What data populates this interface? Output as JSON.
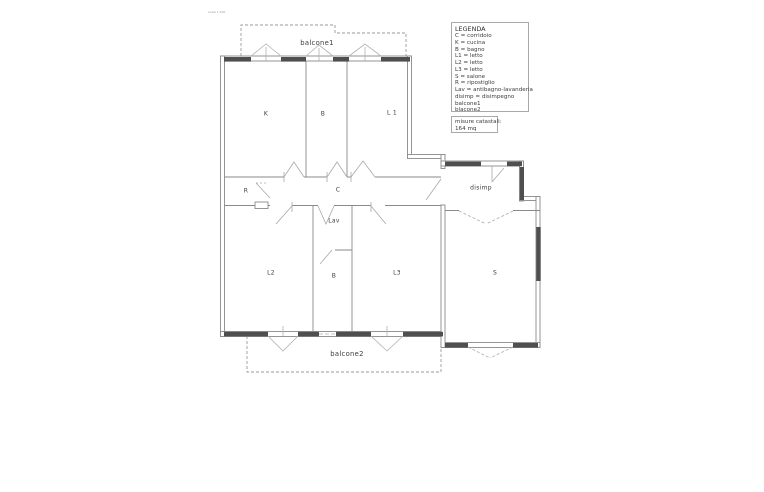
{
  "page": {
    "scale_note": "scala 1:100"
  },
  "legend": {
    "title": "LEGENDA",
    "lines": [
      "C = corridoio",
      "K = cucina",
      "B = bagno",
      "L1 = letto",
      "L2 = letto",
      "L3 = letto",
      "S = salone",
      "R = ripostiglio",
      "Lav = antibagno-lavanderia",
      "disimp = disimpegno",
      "balcone1",
      "blacone2"
    ]
  },
  "measurements": {
    "lines": [
      "misure catastali:",
      "164 mq"
    ]
  },
  "plan": {
    "rooms": [
      {
        "id": "K",
        "label": "K"
      },
      {
        "id": "B-top",
        "label": "B"
      },
      {
        "id": "L1",
        "label": "L 1"
      },
      {
        "id": "R",
        "label": "R"
      },
      {
        "id": "C",
        "label": "C"
      },
      {
        "id": "disimp",
        "label": "disimp"
      },
      {
        "id": "Lav",
        "label": "Lav"
      },
      {
        "id": "L2",
        "label": "L2"
      },
      {
        "id": "B-bottom",
        "label": "B"
      },
      {
        "id": "L3",
        "label": "L3"
      },
      {
        "id": "S",
        "label": "S"
      }
    ],
    "balconies": [
      {
        "id": "balcone1",
        "label": "balcone1"
      },
      {
        "id": "balcone2",
        "label": "balcone2"
      }
    ]
  },
  "colors": {
    "wall": "#8a8a8a",
    "window_fill": "#4f4f4f",
    "door_swing": "#a8a8a8",
    "balcony_dash": "#9a9a9a",
    "text": "#3a3a3a",
    "box_border": "#a8a8a8"
  }
}
